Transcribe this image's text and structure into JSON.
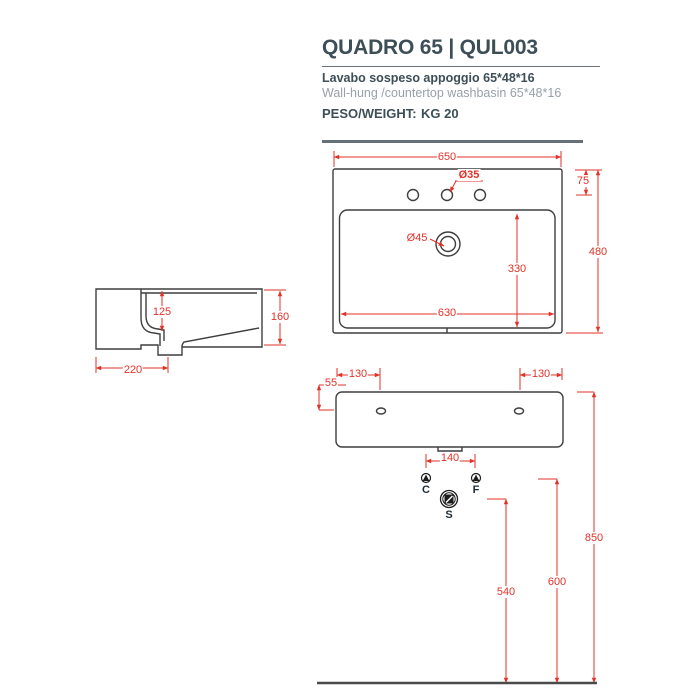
{
  "header": {
    "title": "QUADRO 65 | QUL003",
    "subtitle_it": "Lavabo  sospeso appoggio 65*48*16",
    "subtitle_en": "Wall-hung /countertop washbasin 65*48*16",
    "weight_label": "PESO/WEIGHT:",
    "weight_value": "KG 20"
  },
  "colors": {
    "accent_red": "#e23228",
    "ink": "#3d4e57",
    "muted_gray": "#97a1a8",
    "drawing_line": "#3f3f3f"
  },
  "top_view": {
    "overall_width": "650",
    "faucet_offset": "75",
    "overall_depth": "480",
    "faucet_hole_diameter": "Ø35",
    "drain_diameter": "Ø45",
    "inner_depth": "330",
    "inner_width": "630"
  },
  "side_view": {
    "basin_inner_depth": "125",
    "overall_height": "160",
    "drain_distance": "220"
  },
  "front_view": {
    "hole_offset_left": "130",
    "hole_offset_right": "130",
    "hole_top_offset": "55",
    "tap_spacing": "140",
    "cold_label": "C",
    "hot_label": "F",
    "siphon_label": "S",
    "siphon_height": "540",
    "supply_height": "600",
    "rim_height": "850"
  }
}
